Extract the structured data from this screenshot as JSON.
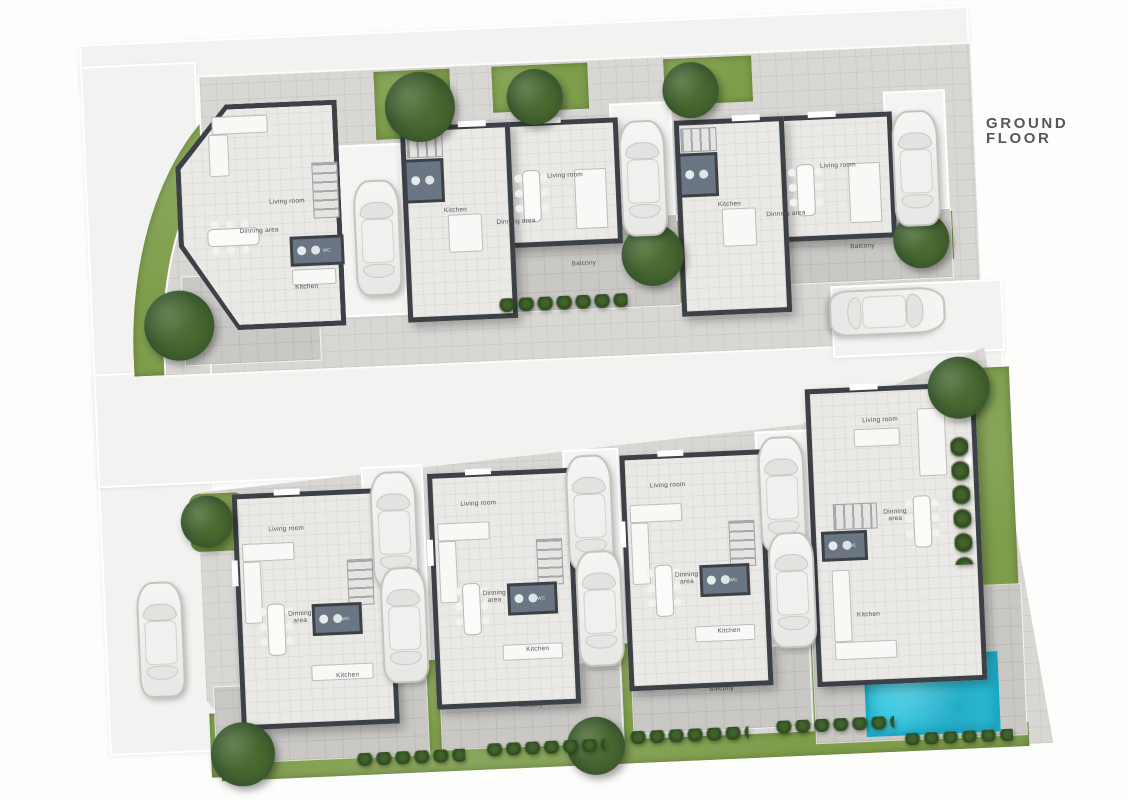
{
  "title": "GROUND FLOOR",
  "units": [
    {
      "rooms": {
        "living": "Living room",
        "dining": "Dinning area",
        "kitchen": "Kitchen",
        "wc": "WC",
        "balcony": "Balcony"
      }
    },
    {
      "rooms": {
        "living": "Living room",
        "dining": "Dinning area",
        "kitchen": "Kitchen",
        "wc": "WC",
        "balcony": "Balcony"
      }
    },
    {
      "rooms": {
        "living": "Living room",
        "dining": "Dinning area",
        "kitchen": "Kitchen",
        "wc": "WC",
        "balcony": "Balcony"
      }
    },
    {
      "rooms": {
        "living": "Living room",
        "dining": "Dinning area",
        "kitchen": "Kitchen",
        "wc": "WC",
        "balcony": "Balcony"
      }
    },
    {
      "rooms": {
        "living": "Living room",
        "dining": "Dinning area",
        "kitchen": "Kitchen",
        "wc": "WC",
        "balcony": "Balcony"
      }
    },
    {
      "rooms": {
        "living": "Living room",
        "dining": "Dinning area",
        "kitchen": "Kitchen",
        "wc": "WC",
        "balcony": "Balcony"
      }
    },
    {
      "rooms": {
        "living": "Living room",
        "dining": "Dinning area",
        "kitchen": "Kitchen",
        "wc": "WC",
        "balcony": "Balcony"
      }
    }
  ],
  "pool": {
    "label": "Swimming pool area"
  },
  "colors": {
    "grass": "#7e9d4b",
    "pool_water": "#2cc4de",
    "walls": "#3c4147",
    "paving": "#d8d7d4",
    "road": "#f2f2f0"
  }
}
